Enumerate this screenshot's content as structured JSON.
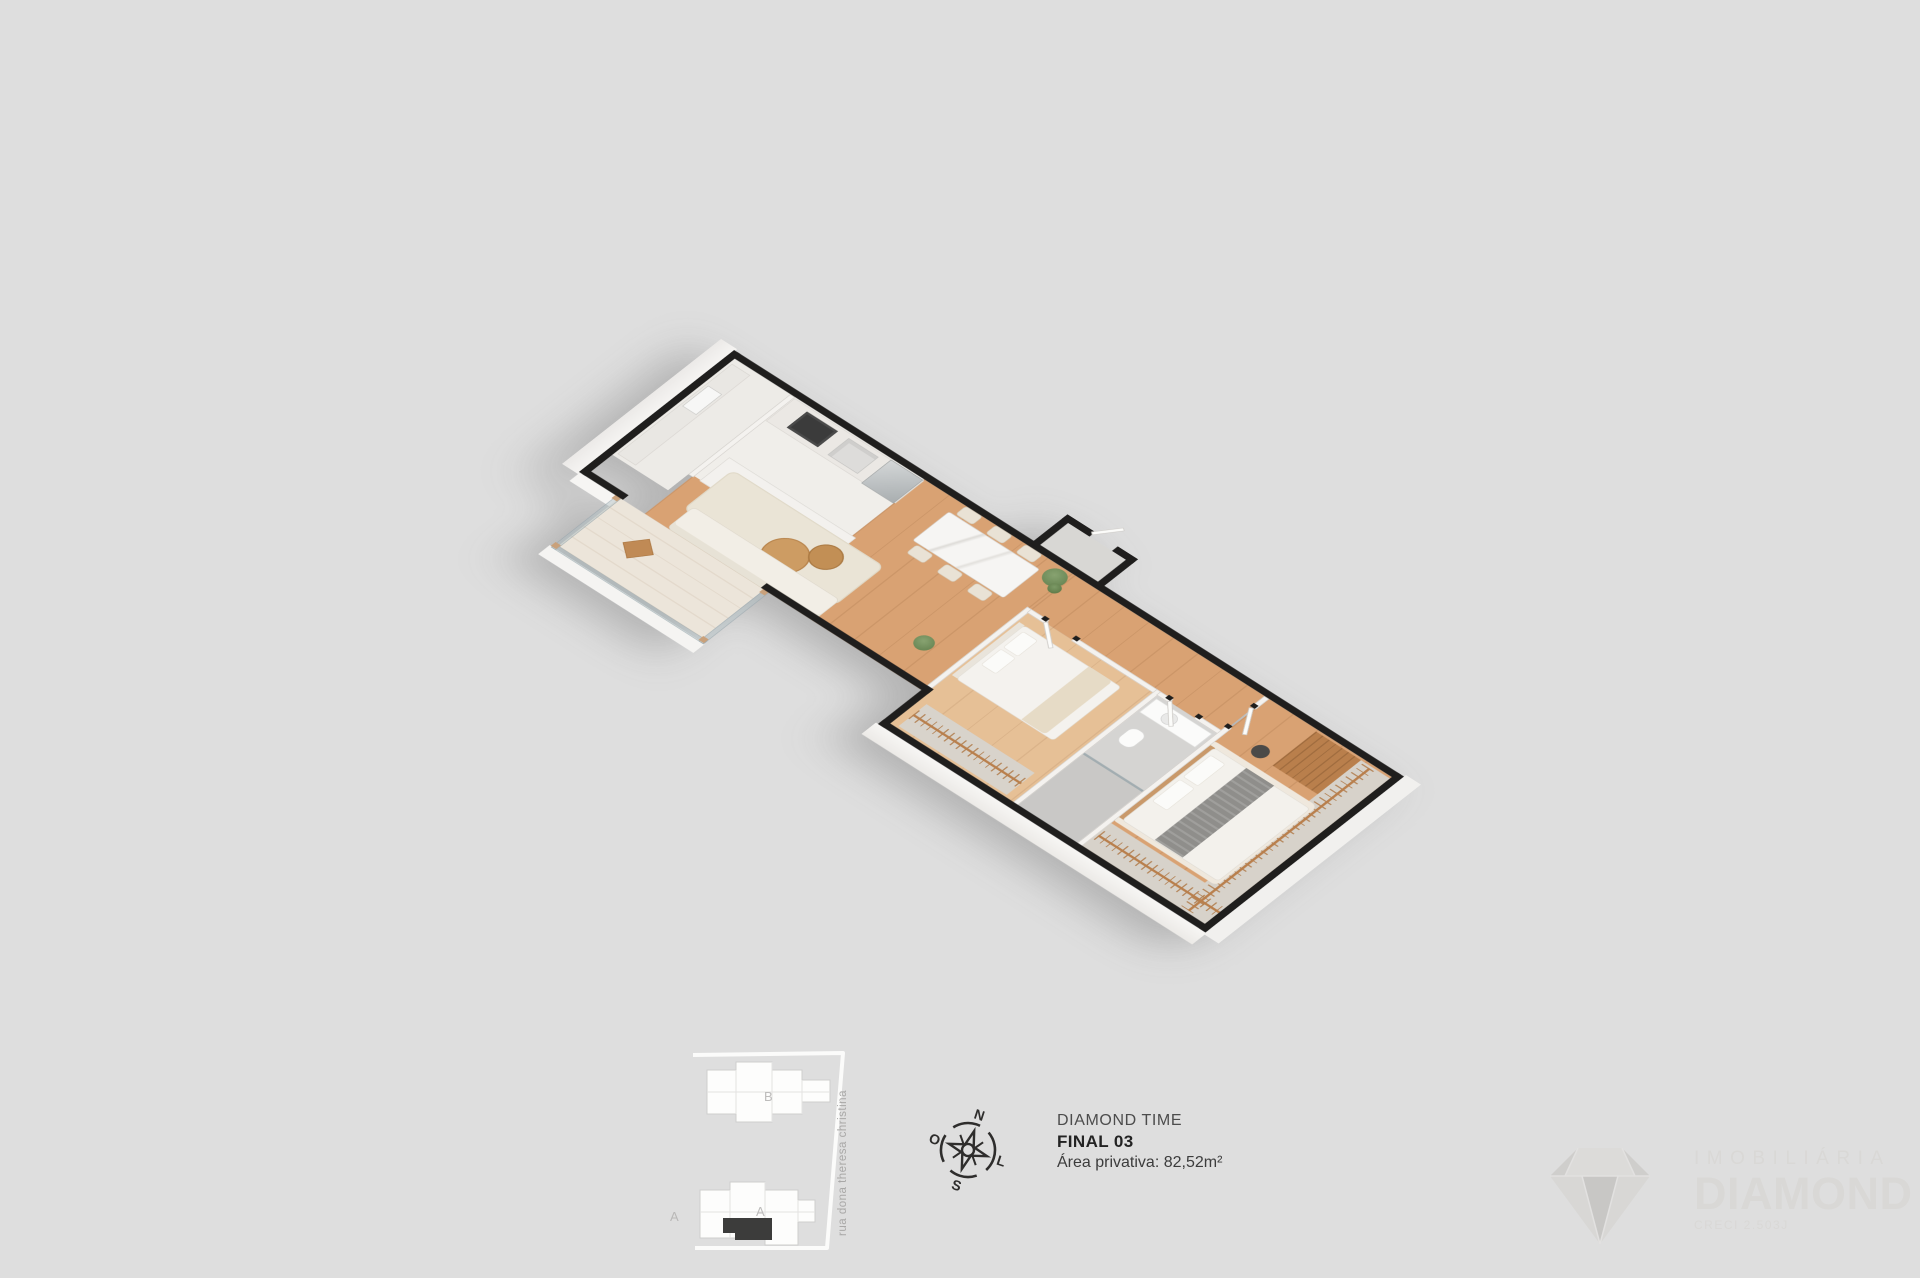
{
  "unit_info": {
    "project": "DIAMOND TIME",
    "unit": "FINAL 03",
    "area": "Área privativa: 82,52m²"
  },
  "compass": {
    "n": "N",
    "s": "S",
    "w": "O",
    "e": "L"
  },
  "site_plan": {
    "building_b": "B",
    "building_a": "A",
    "block": "A",
    "street": "rua dona theresa christina",
    "highlight_color": "#3c3c3b"
  },
  "brand": {
    "line_top": "IMOBILIÁRIA",
    "line_main": "DIAMOND",
    "line_creci": "CRECI 2.503J",
    "icon": "diamond-icon"
  },
  "colors": {
    "bg": "#dedede",
    "wall": "#1f1e1d",
    "wood": "#d9a273",
    "wood-light": "#e6c096",
    "tile": "#d5d4d2",
    "rug": "#eae4d6",
    "closet-wood": "#b97f4c",
    "text-dark": "#232323",
    "brand": "#d9d8d6"
  }
}
